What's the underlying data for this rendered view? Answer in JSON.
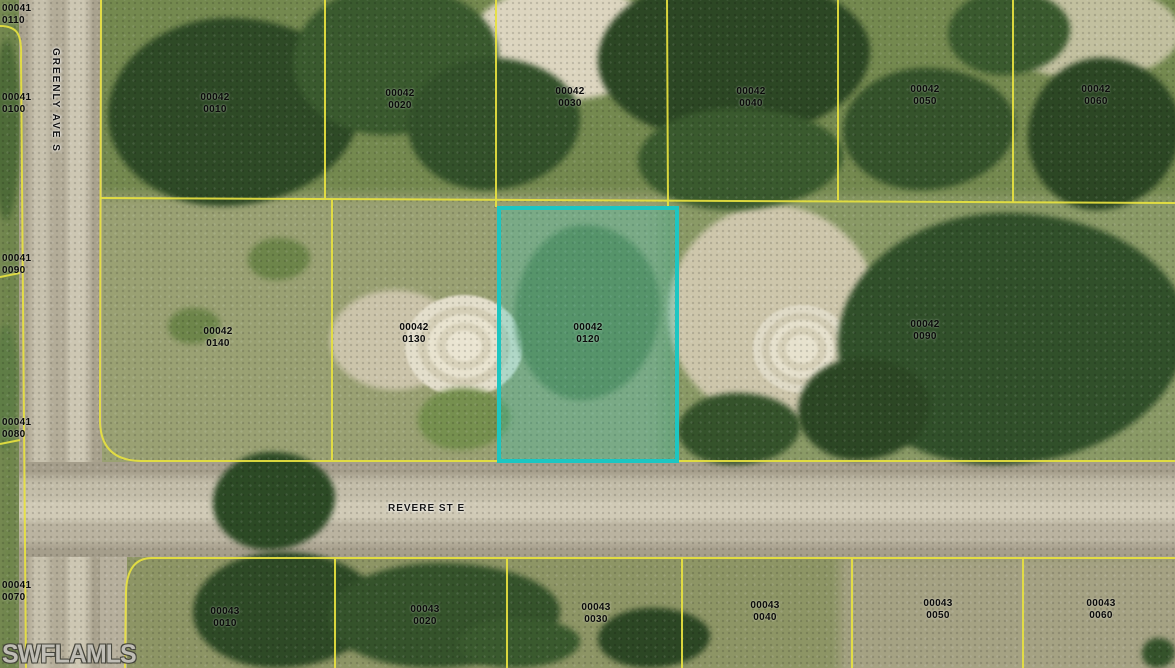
{
  "watermark": "SWFLAMLS",
  "streets": {
    "greenly": "GREENLY AVE S",
    "revere": "REVERE ST E"
  },
  "colors": {
    "parcel_line": "#e8e240",
    "highlight_border": "#1dc6c2",
    "highlight_fill": "rgba(32,196,190,0.26)"
  },
  "parcels": {
    "left_0110": "00041\n0110",
    "left_0100": "00041\n0100",
    "left_0090": "00041\n0090",
    "left_0080": "00041\n0080",
    "left_0070": "00041\n0070",
    "top_0010": "00042\n0010",
    "top_0020": "00042\n0020",
    "top_0030": "00042\n0030",
    "top_0040": "00042\n0040",
    "top_0050": "00042\n0050",
    "top_0060": "00042\n0060",
    "mid_0140": "00042\n0140",
    "mid_0130": "00042\n0130",
    "mid_0120": "00042\n0120",
    "mid_0090": "00042\n0090",
    "bot_0010": "00043\n0010",
    "bot_0020": "00043\n0020",
    "bot_0030": "00043\n0030",
    "bot_0040": "00043\n0040",
    "bot_0050": "00043\n0050",
    "bot_0060": "00043\n0060"
  }
}
